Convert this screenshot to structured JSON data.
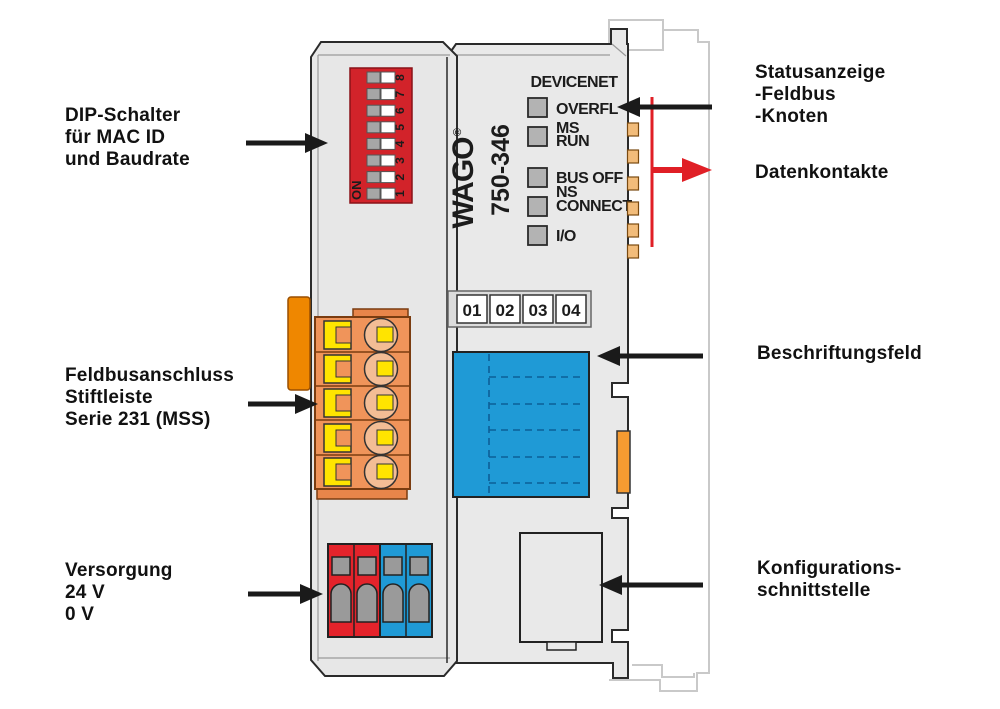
{
  "device": {
    "brand": "WAGO",
    "registered_mark": "®",
    "model": "750-346",
    "fieldbus_title": "DEVICENET",
    "led_labels": [
      "OVERFL",
      "MS",
      "RUN",
      "BUS OFF",
      "NS",
      "CONNECT",
      "I/O"
    ],
    "dip_on_label": "ON",
    "dip_numbers": [
      "1",
      "2",
      "3",
      "4",
      "5",
      "6",
      "7",
      "8"
    ],
    "slot_numbers": [
      "01",
      "02",
      "03",
      "04"
    ]
  },
  "callouts": {
    "dip": {
      "lines": [
        "DIP-Schalter",
        "für MAC ID",
        "und Baudrate"
      ]
    },
    "fieldbus": {
      "lines": [
        "Feldbusanschluss",
        "Stiftleiste",
        "Serie 231 (MSS)"
      ]
    },
    "power": {
      "lines": [
        "Versorgung",
        "24 V",
        "0 V"
      ]
    },
    "status": {
      "lines": [
        "Statusanzeige",
        "-Feldbus",
        "-Knoten"
      ]
    },
    "data_contacts": {
      "lines": [
        "Datenkontakte"
      ]
    },
    "label_field": {
      "lines": [
        "Beschriftungsfeld"
      ]
    },
    "config_interface": {
      "lines": [
        "Konfigurations-",
        "schnittstelle"
      ]
    }
  },
  "colors": {
    "body_gray": "#e9e9e9",
    "dip_red": "#d2232a",
    "power_red": "#e4232b",
    "field_blue": "#1f9ad6",
    "connector_orange": "#f0945a",
    "latch_orange": "#f59b31",
    "clamp_yellow": "#ffe400",
    "brand_green": "#3aaa35",
    "indicator_red": "#e01f26",
    "arrow_black": "#1a1a1a",
    "ghost_gray": "#c9c9c9"
  }
}
